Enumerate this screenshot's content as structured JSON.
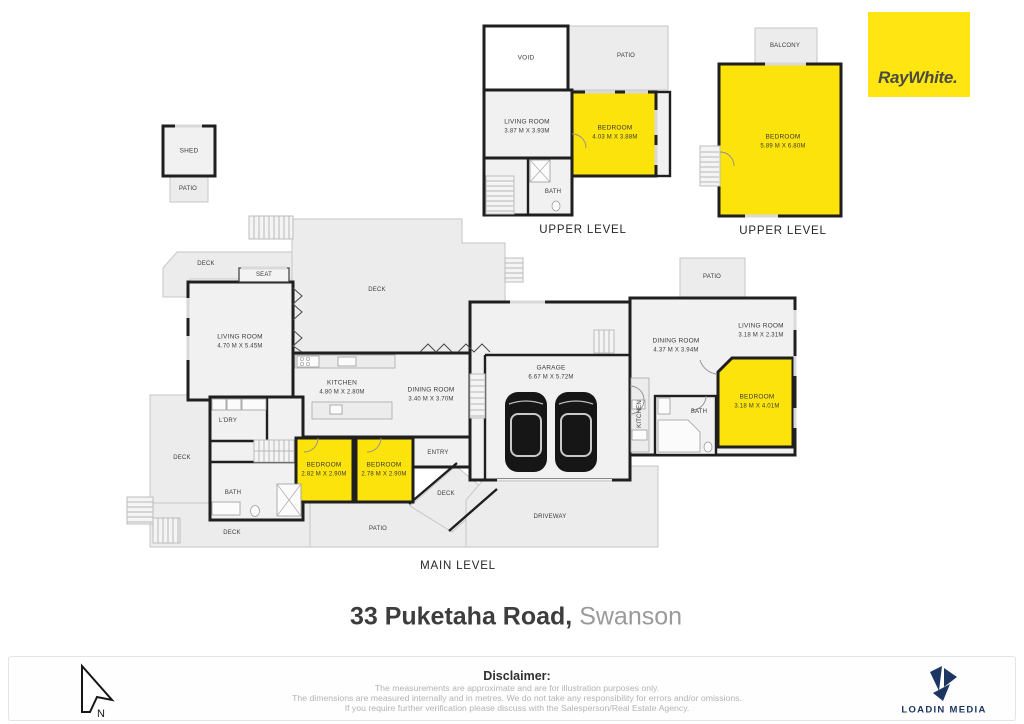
{
  "title": {
    "address": "33 Puketaha Road,",
    "suburb": "Swanson"
  },
  "branding": {
    "raywhite": {
      "text": "RayWhite.",
      "bg_color": "#FFE512",
      "text_color": "#4A4B41"
    },
    "loadin": {
      "text": "LOADIN MEDIA",
      "color": "#1C3661"
    }
  },
  "colors": {
    "highlight_room": "#FBE30B",
    "wall": "#1F1F1F",
    "outdoor_fill": "#ECECEC",
    "room_fill": "#F1F1F1"
  },
  "compass": {
    "label": "N"
  },
  "shed_plan": {
    "shed": "SHED",
    "patio": "PATIO"
  },
  "upper1": {
    "caption": "UPPER LEVEL",
    "void": "VOID",
    "patio": "PATIO",
    "living": {
      "name": "LIVING ROOM",
      "dims": "3.87 M X 3.93M"
    },
    "bedroom": {
      "name": "BEDROOM",
      "dims": "4.03 M X 3.88M"
    },
    "bath": "BATH"
  },
  "upper2": {
    "caption": "UPPER LEVEL",
    "balcony": "BALCONY",
    "bedroom": {
      "name": "BEDROOM",
      "dims": "5.89 M X 6.80M"
    }
  },
  "main": {
    "caption": "MAIN LEVEL",
    "deck_top": "DECK",
    "seat": "SEAT",
    "living1": {
      "name": "LIVING ROOM",
      "dims": "4.70 M X 5.45M"
    },
    "deck_big": "DECK",
    "kitchen": {
      "name": "KITCHEN",
      "dims": "4.80 M X 2.80M"
    },
    "dining1": {
      "name": "DINING ROOM",
      "dims": "3.40 M X 3.70M"
    },
    "garage": {
      "name": "GARAGE",
      "dims": "6.67 M X 5.72M"
    },
    "dining2": {
      "name": "DINING ROOM",
      "dims": "4.37 M X 3.94M"
    },
    "living2": {
      "name": "LIVING ROOM",
      "dims": "3.18 M X 2.31M"
    },
    "patio_right": "PATIO",
    "bedroom3": {
      "name": "BEDROOM",
      "dims": "3.18 M X 4.01M"
    },
    "bath2": "BATH",
    "kitchen_side": "KITCHEN",
    "ldry": "L'DRY",
    "deck_left": "DECK",
    "bath1": "BATH",
    "bedroom1": {
      "name": "BEDROOM",
      "dims": "2.82 M X 2.90M"
    },
    "bedroom2": {
      "name": "BEDROOM",
      "dims": "2.78 M X 2.90M"
    },
    "entry": "ENTRY",
    "deck_entry": "DECK",
    "deck_bottom": "DECK",
    "patio_bottom": "PATIO",
    "driveway": "DRIVEWAY"
  },
  "footer": {
    "heading": "Disclaimer:",
    "lines": [
      "The measurements are approximate and are for illustration purposes only.",
      "The dimensions are measured internally and in metres. We do not take any responsibility for errors and/or omissions.",
      "If you require further verification please discuss with the Salesperson/Real Estate Agency."
    ]
  }
}
